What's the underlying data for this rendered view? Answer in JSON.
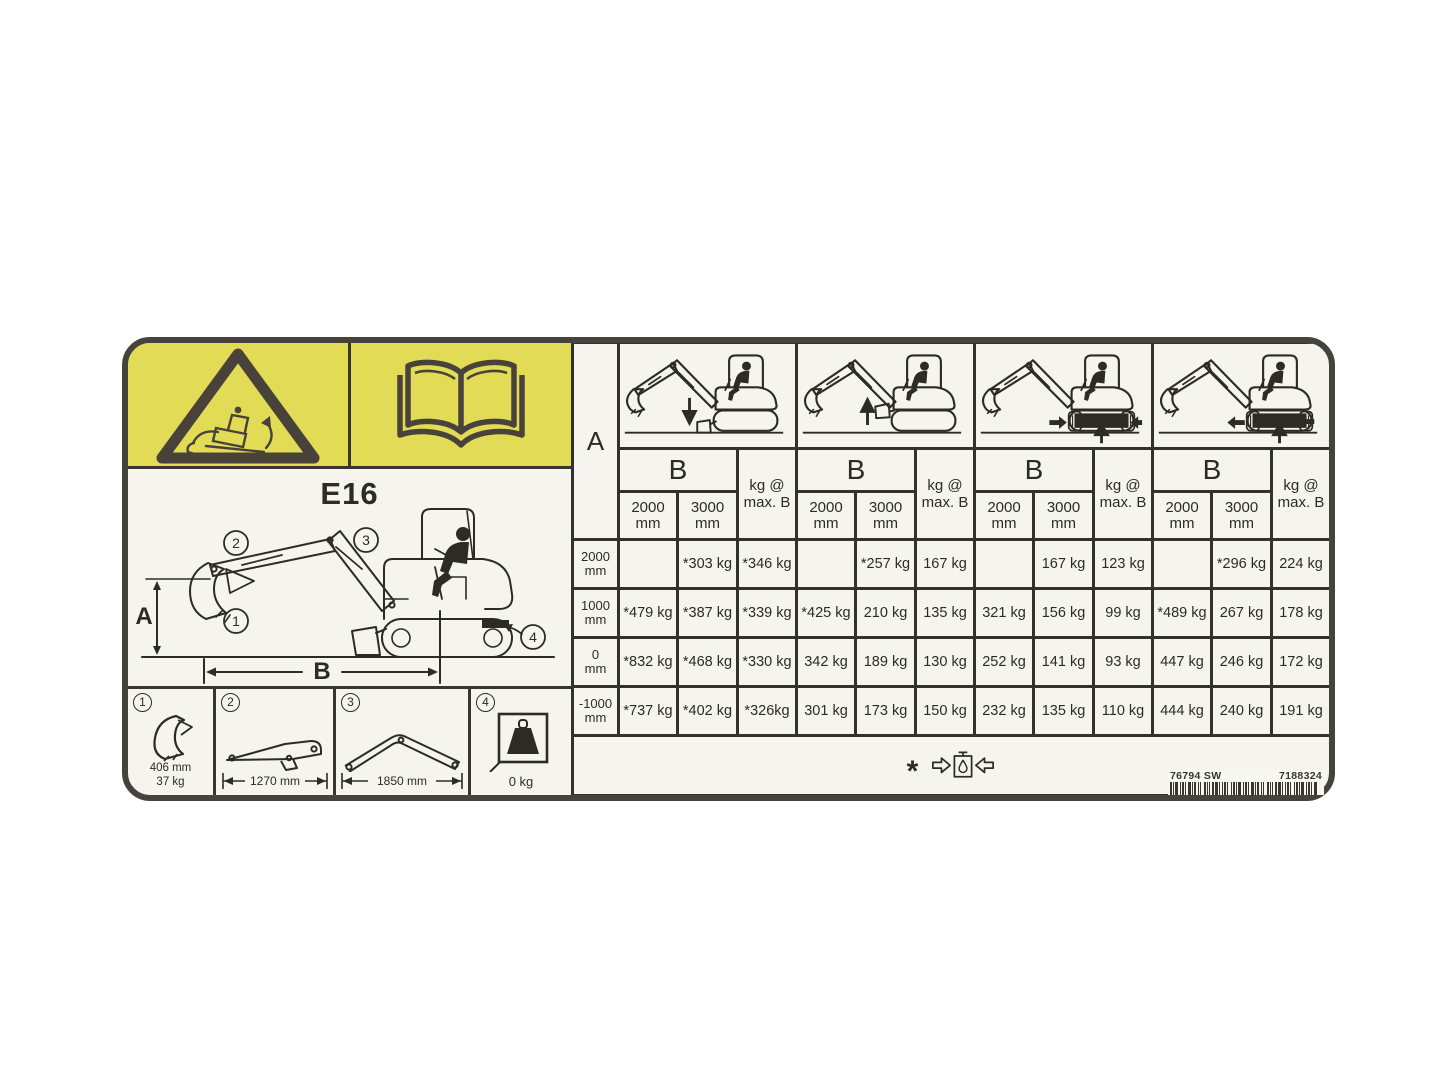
{
  "decal": {
    "model": "E16",
    "colors": {
      "banner_yellow": "#e2db56",
      "border": "#46423c",
      "ink": "#2e2a26",
      "label_bg": "#f6f4ee"
    },
    "icons": {
      "warning": "tip-over-warning-triangle",
      "manual": "operator-manual-book",
      "footnote": "hydraulic-capacity-limit",
      "configs": [
        "excavator-blade-down",
        "excavator-blade-up",
        "excavator-undercarriage-retracted",
        "excavator-undercarriage-extended"
      ]
    },
    "diagram": {
      "dim_a": "A",
      "dim_b": "B",
      "callout_1": "1",
      "callout_2": "2",
      "callout_3": "3",
      "callout_4": "4"
    },
    "components": [
      {
        "num": "1",
        "name": "bucket",
        "dim": "406 mm",
        "weight": "37 kg"
      },
      {
        "num": "2",
        "name": "arm",
        "dim": "1270 mm"
      },
      {
        "num": "3",
        "name": "boom",
        "dim": "1850 mm"
      },
      {
        "num": "4",
        "name": "counterweight",
        "weight": "0 kg"
      }
    ],
    "table": {
      "corner_label": "A",
      "b_label": "B",
      "kg_max_label": "kg @\nmax. B",
      "reach_cols": [
        "2000\nmm",
        "3000\nmm"
      ],
      "row_heads": [
        "2000\nmm",
        "1000\nmm",
        "0\nmm",
        "-1000\nmm"
      ],
      "configs": [
        {
          "icon": "excavator-blade-down",
          "rows": [
            [
              "",
              "*303 kg",
              "*346 kg"
            ],
            [
              "*479 kg",
              "*387 kg",
              "*339 kg"
            ],
            [
              "*832 kg",
              "*468 kg",
              "*330 kg"
            ],
            [
              "*737 kg",
              "*402 kg",
              "*326kg"
            ]
          ]
        },
        {
          "icon": "excavator-blade-up",
          "rows": [
            [
              "",
              "*257 kg",
              "167 kg"
            ],
            [
              "*425 kg",
              "210 kg",
              "135 kg"
            ],
            [
              "342 kg",
              "189 kg",
              "130 kg"
            ],
            [
              "301 kg",
              "173 kg",
              "150 kg"
            ]
          ]
        },
        {
          "icon": "excavator-undercarriage-retracted",
          "rows": [
            [
              "",
              "167 kg",
              "123 kg"
            ],
            [
              "321 kg",
              "156 kg",
              "99 kg"
            ],
            [
              "252 kg",
              "141 kg",
              "93 kg"
            ],
            [
              "232 kg",
              "135 kg",
              "110 kg"
            ]
          ]
        },
        {
          "icon": "excavator-undercarriage-extended",
          "rows": [
            [
              "",
              "*296 kg",
              "224 kg"
            ],
            [
              "*489 kg",
              "267 kg",
              "178 kg"
            ],
            [
              "447 kg",
              "246 kg",
              "172 kg"
            ],
            [
              "444 kg",
              "240 kg",
              "191 kg"
            ]
          ]
        }
      ],
      "footnote_star": "*"
    },
    "part_numbers": {
      "left": "76794 SW",
      "right": "7188324"
    }
  }
}
